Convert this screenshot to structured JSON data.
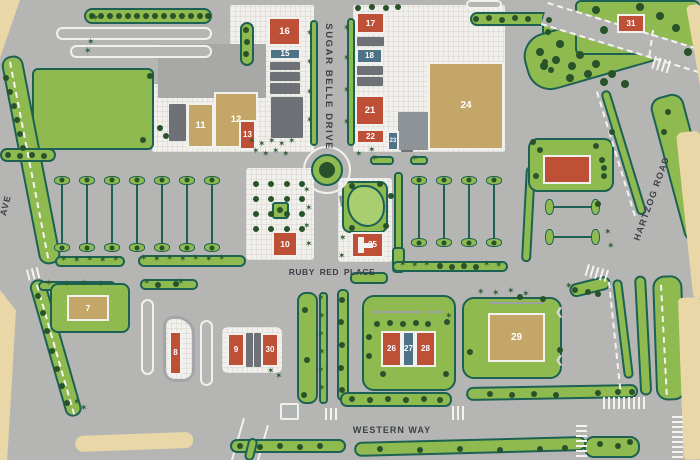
{
  "map": {
    "streets": {
      "sugar_belle": "SUGAR BELLE DRIVE",
      "ruby_red": "RUBY RED PLACE",
      "western": "WESTERN WAY",
      "hartzog": "HARTZOG ROAD",
      "ave": "AVE"
    },
    "buildings": [
      {
        "id": "7",
        "label": "7",
        "type": "tan"
      },
      {
        "id": "8",
        "label": "8",
        "type": "red"
      },
      {
        "id": "9",
        "label": "9",
        "type": "red"
      },
      {
        "id": "10",
        "label": "10",
        "type": "red"
      },
      {
        "id": "11",
        "label": "11",
        "type": "tan"
      },
      {
        "id": "12",
        "label": "12",
        "type": "tan"
      },
      {
        "id": "13",
        "label": "13",
        "type": "red"
      },
      {
        "id": "15",
        "label": "15",
        "type": "blue"
      },
      {
        "id": "16",
        "label": "16",
        "type": "red"
      },
      {
        "id": "17",
        "label": "17",
        "type": "red"
      },
      {
        "id": "18",
        "label": "18",
        "type": "blue"
      },
      {
        "id": "21",
        "label": "21",
        "type": "red"
      },
      {
        "id": "22",
        "label": "22",
        "type": "red"
      },
      {
        "id": "23",
        "label": "23",
        "type": "blue"
      },
      {
        "id": "24",
        "label": "24",
        "type": "tan"
      },
      {
        "id": "25",
        "label": "25",
        "type": "red"
      },
      {
        "id": "26",
        "label": "26",
        "type": "red"
      },
      {
        "id": "27",
        "label": "27",
        "type": "blue"
      },
      {
        "id": "28",
        "label": "28",
        "type": "red"
      },
      {
        "id": "29",
        "label": "29",
        "type": "tan"
      },
      {
        "id": "30",
        "label": "30",
        "type": "red"
      },
      {
        "id": "31",
        "label": "31",
        "type": "red"
      }
    ],
    "colors": {
      "road_gray": "#b5b6b4",
      "pavement_white": "#f1f0ec",
      "landscape_green": "#8eba50",
      "pond_green": "#a9ce6f",
      "outline_teal": "#1d6154",
      "tree_green": "#27522a",
      "building_red": "#bf5038",
      "building_blue": "#4e7386",
      "building_tan": "#c4a768",
      "building_gray": "#6e7276",
      "parcel_beige": "#ead7a8",
      "street_label": "#3b4046"
    }
  }
}
